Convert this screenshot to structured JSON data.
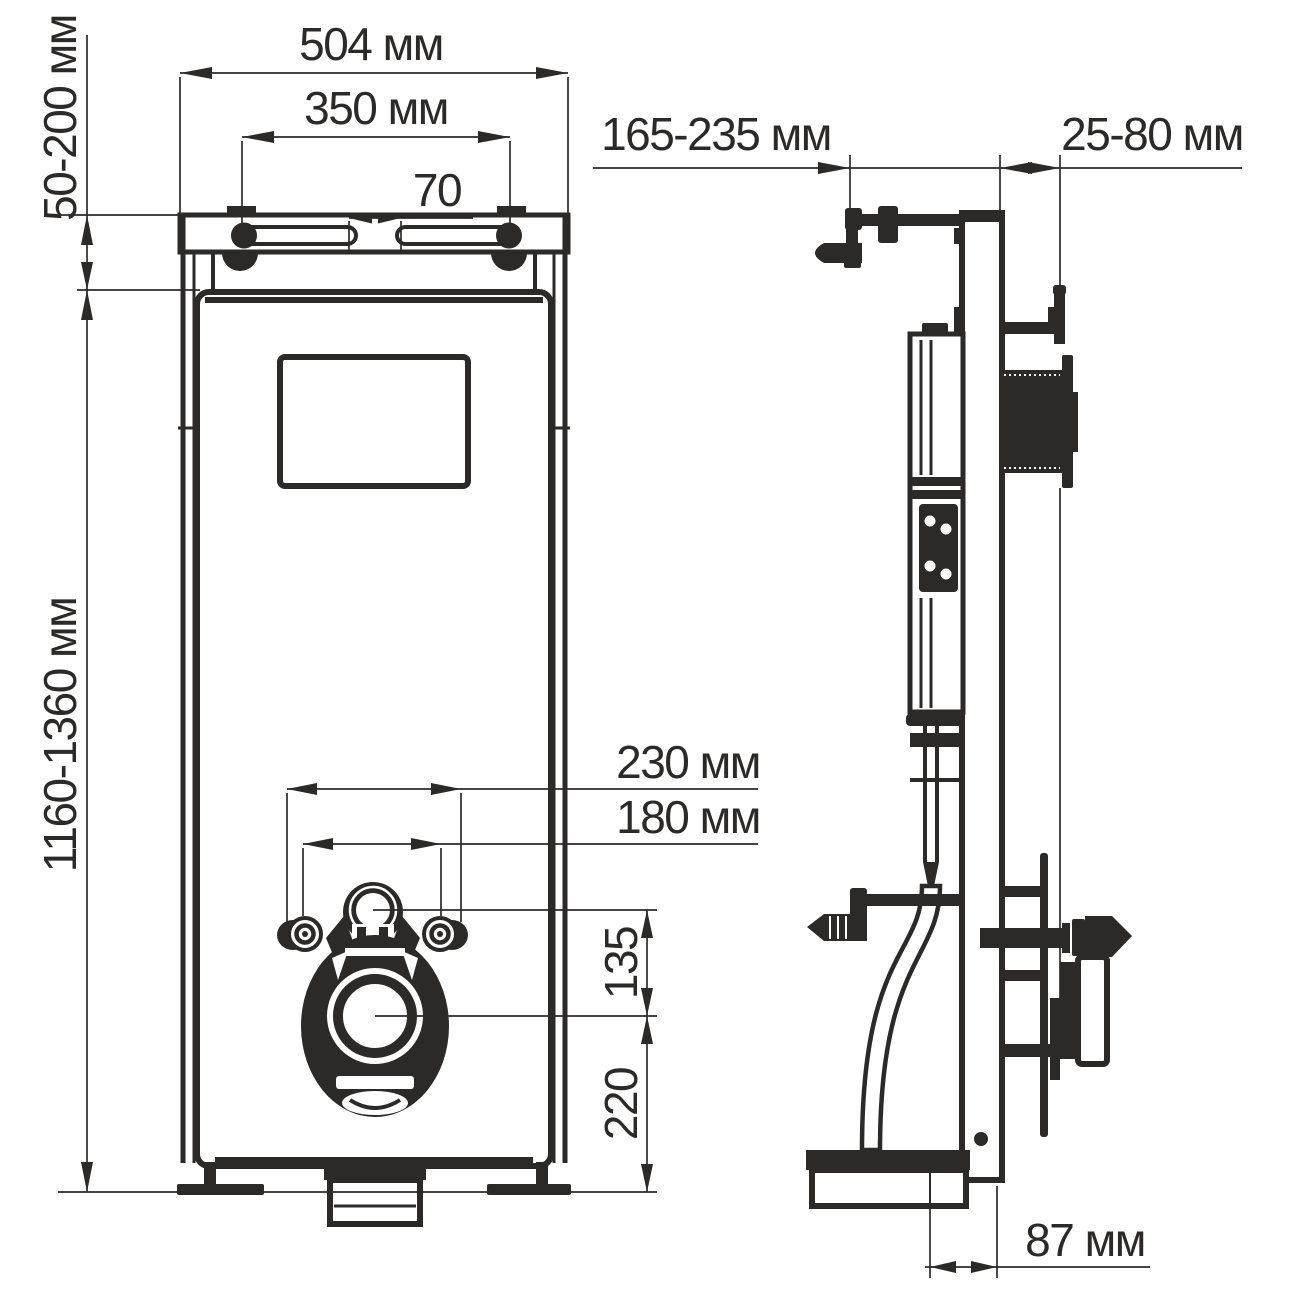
{
  "drawing": {
    "background": "#ffffff",
    "line_color": "#2b2a29",
    "unit": "мм",
    "dimensions": {
      "top_width": "504 мм",
      "mounting_slot_spacing": "350 мм",
      "slot_gap": "70",
      "top_clearance": "50-200 мм",
      "frame_height": "1160-1360 мм",
      "front_depth": "165-235 мм",
      "wall_offset": "25-80 мм",
      "outer_fixing_width": "230 мм",
      "fixing_bolt_spacing": "180 мм",
      "outlet_vertical_offset": "135",
      "outlet_floor_height": "220",
      "foot_to_face_offset": "87 мм"
    }
  }
}
